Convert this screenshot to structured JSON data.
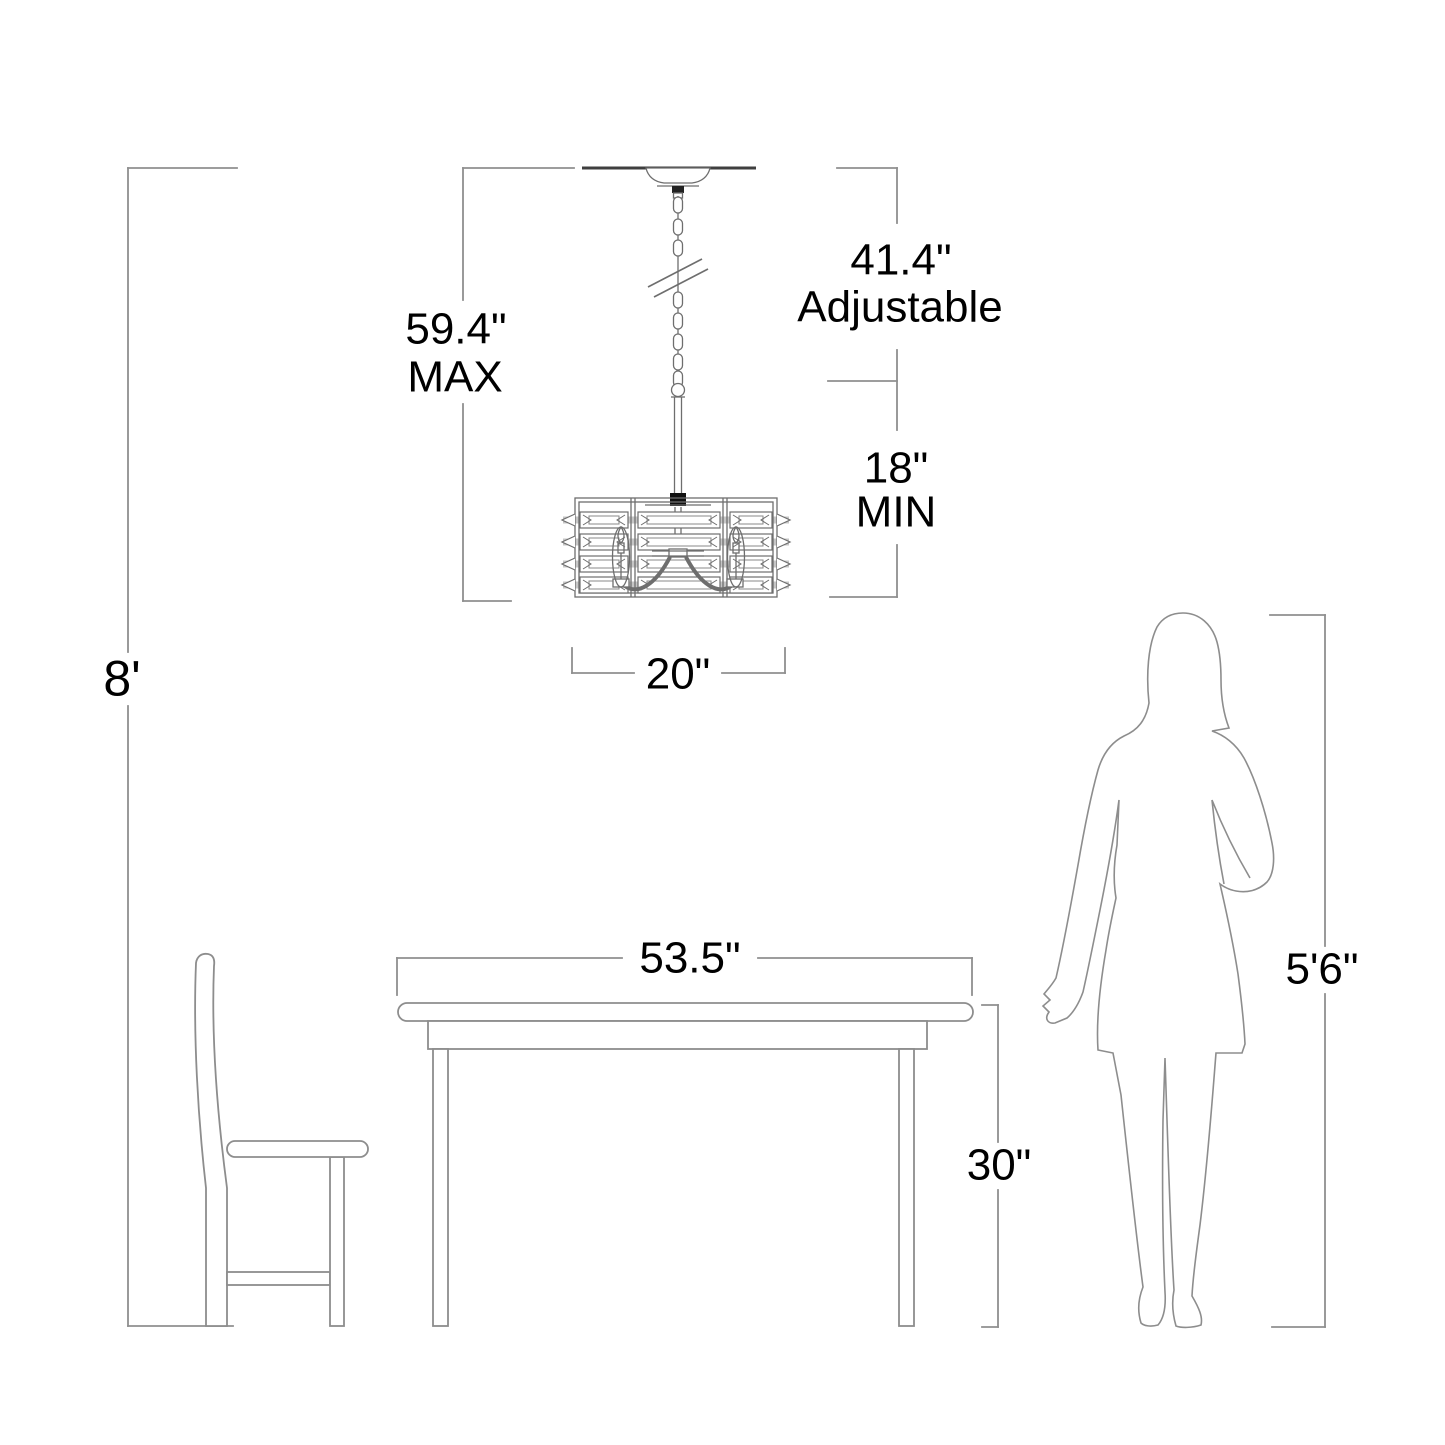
{
  "diagram": {
    "title": "Chandelier hanging-height dimension diagram",
    "dimensions": {
      "ceiling_height": {
        "label": "8'"
      },
      "max_overall": {
        "value": "59.4\"",
        "qualifier": "MAX"
      },
      "adjustable_range": {
        "value": "41.4\"",
        "qualifier": "Adjustable"
      },
      "min_hang": {
        "value": "18\"",
        "qualifier": "MIN"
      },
      "shade_width": {
        "value": "20\""
      },
      "table_width": {
        "value": "53.5\""
      },
      "table_height": {
        "value": "30\""
      },
      "person_height": {
        "value": "5'6\""
      }
    },
    "colors": {
      "background": "#ffffff",
      "dimension_line": "#8f8f8f",
      "drawing_line": "#6e6e6e",
      "ceiling_line": "#3f3f3f",
      "text": "#000000",
      "crystal_band_fill": "#c6c6c6"
    }
  }
}
